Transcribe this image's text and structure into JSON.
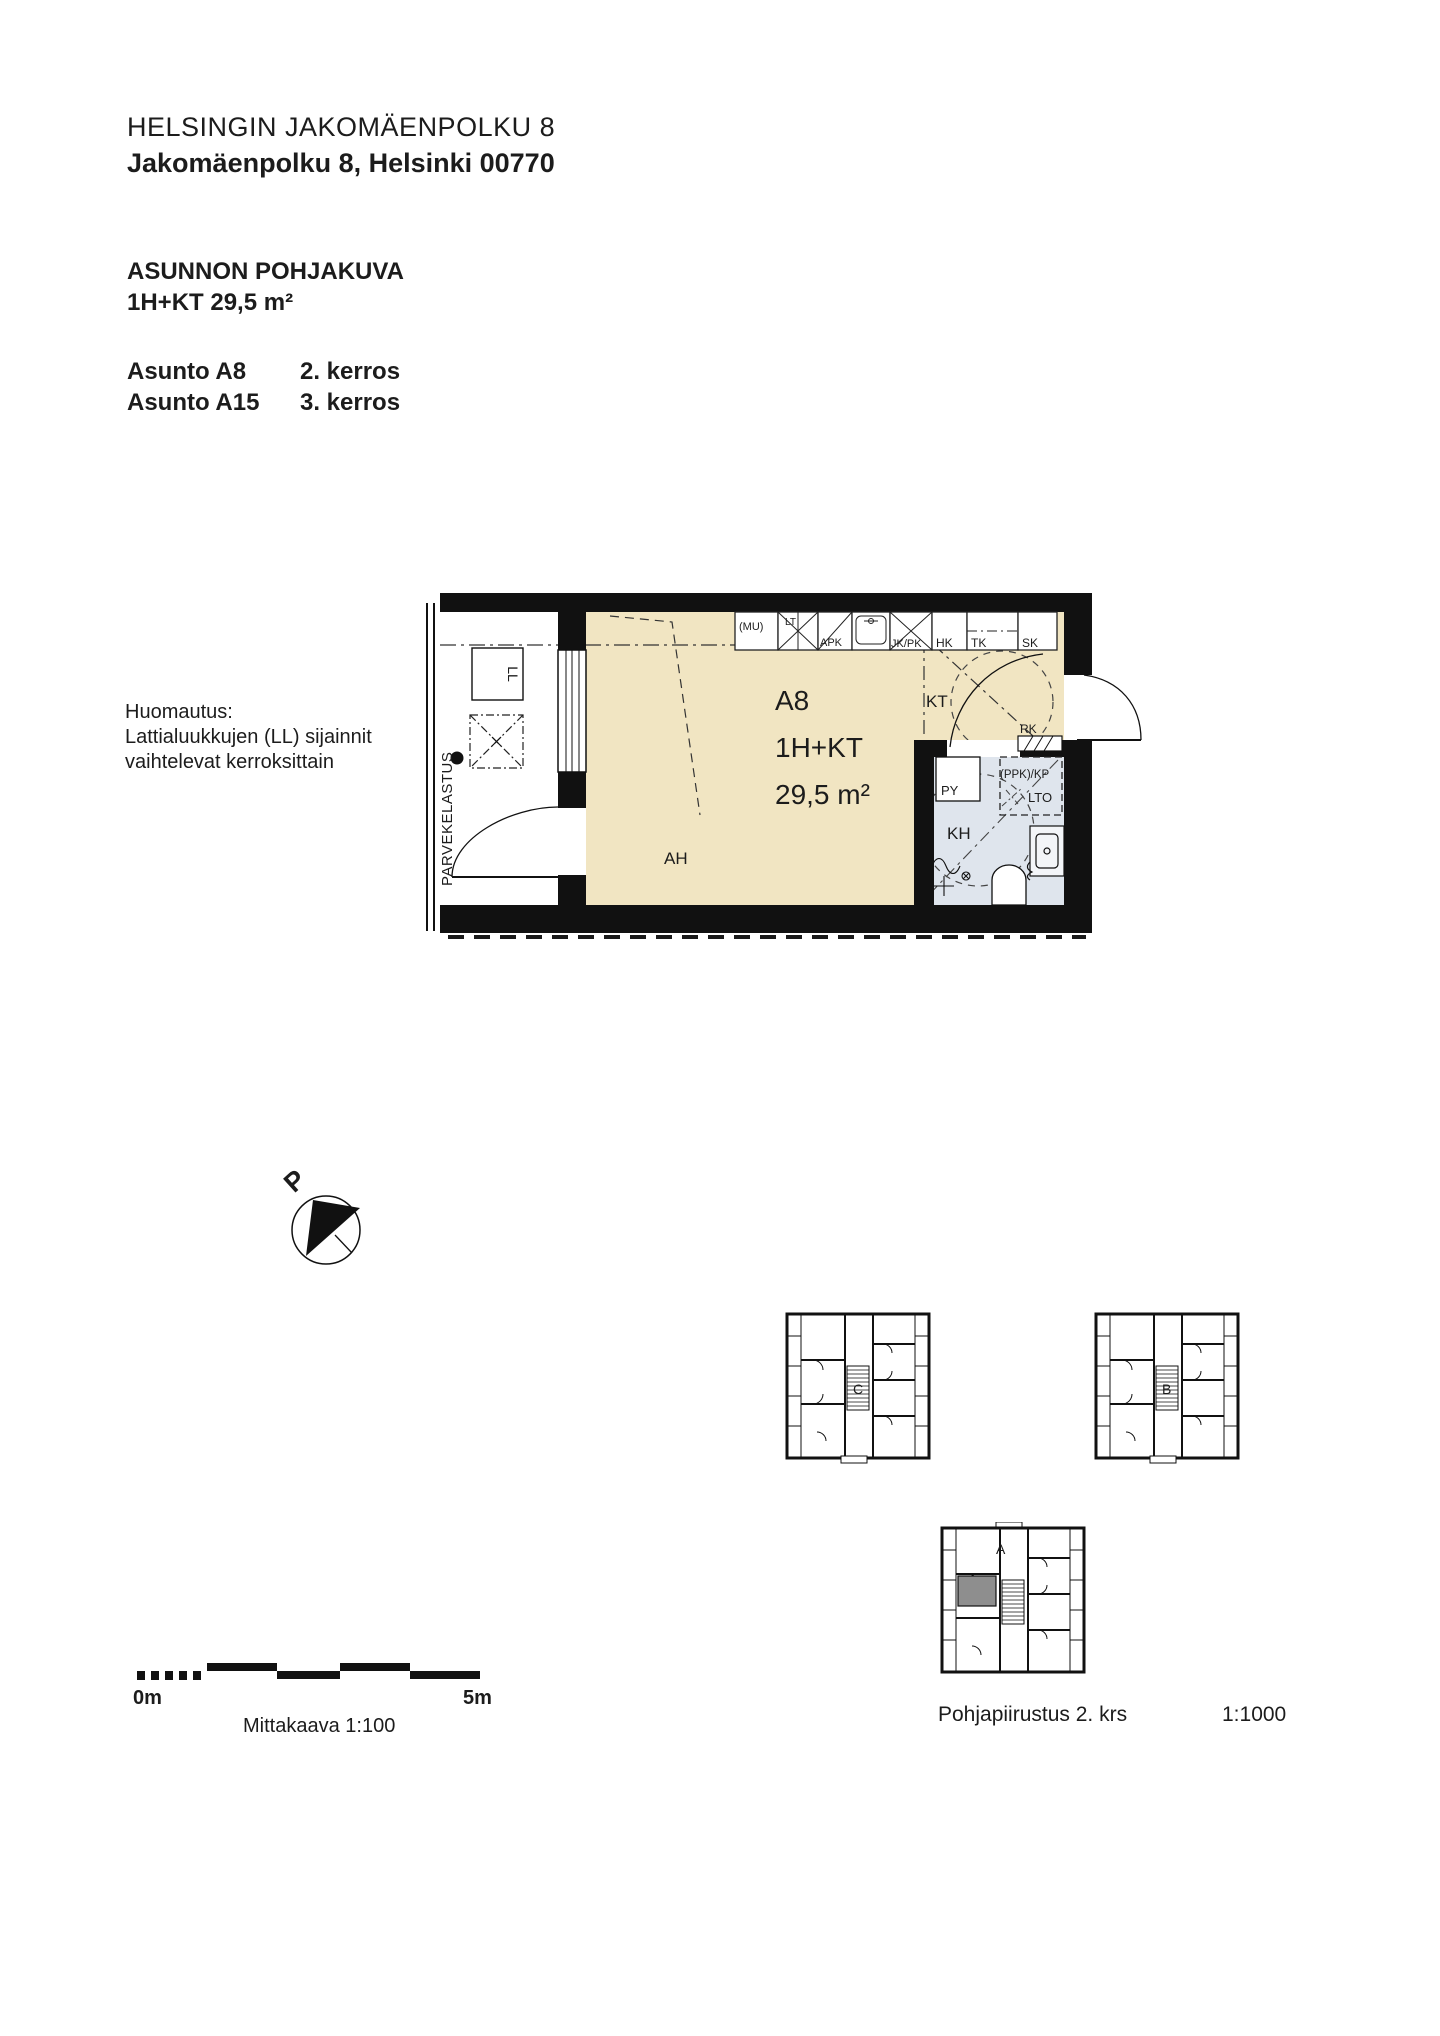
{
  "header": {
    "title": "HELSINGIN JAKOMÄENPOLKU 8",
    "address": "Jakomäenpolku 8, Helsinki 00770",
    "drawing_type": "ASUNNON POHJAKUVA",
    "apartment_type": "1H+KT 29,5 m²",
    "units": [
      {
        "name": "Asunto A8",
        "floor": "2. kerros"
      },
      {
        "name": "Asunto A15",
        "floor": "3. kerros"
      }
    ]
  },
  "note": {
    "line1": "Huomautus:",
    "line2": "Lattialuukkujen (LL) sijainnit",
    "line3": "vaihtelevat kerroksittain"
  },
  "plan": {
    "unit_id": "A8",
    "unit_type": "1H+KT",
    "area": "29,5 m²",
    "rooms": {
      "living": "AH",
      "kitchen": "KT",
      "bathroom": "KH"
    },
    "labels": {
      "balcony_loading": "PARVEKELASTUS",
      "floor_hatch": "LL",
      "electrical_cabinet": "RK",
      "laundry_reserve": "(PPK)/KP",
      "heat_recovery": "LTO",
      "washbasin_cabinet": "PY",
      "microwave": "(MU)",
      "stove": "LT",
      "dishwasher": "APK",
      "fridge_freezer": "JK/PK",
      "cabinet_hk": "HK",
      "cabinet_tk": "TK",
      "cabinet_sk": "SK"
    }
  },
  "compass": {
    "north": "P"
  },
  "scalebar": {
    "start": "0m",
    "end": "5m",
    "caption": "Mittakaava 1:100"
  },
  "keyplans": {
    "building_c": "C",
    "building_b": "B",
    "building_a": "A",
    "caption": "Pohjapiirustus 2. krs",
    "scale": "1:1000"
  },
  "colors": {
    "room_fill": "#f1e5c2",
    "bathroom_fill": "#dfe5ed",
    "highlight": "#8e8e8e",
    "wall": "#111111"
  }
}
